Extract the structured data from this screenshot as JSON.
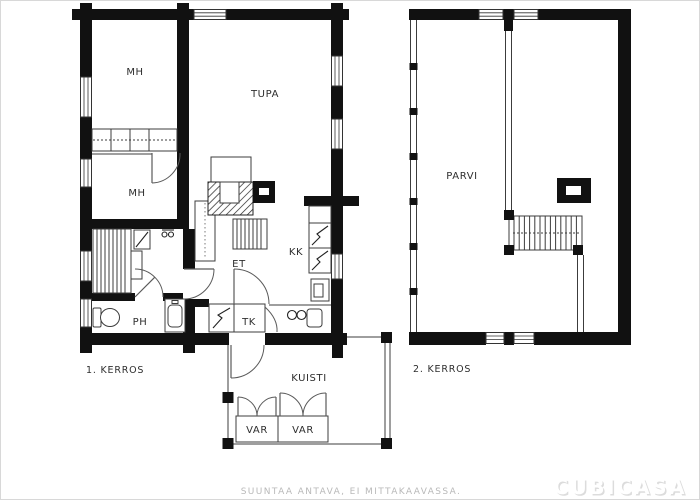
{
  "floor1": {
    "label": "1. KERROS",
    "rooms": {
      "mh1": "MH",
      "tupa": "TUPA",
      "mh2": "MH",
      "et": "ET",
      "kk": "KK",
      "ph": "PH",
      "tk": "TK"
    }
  },
  "porch": {
    "label": "KUISTI",
    "storage1": "VAR",
    "storage2": "VAR"
  },
  "floor2": {
    "label": "2. KERROS",
    "rooms": {
      "parvi": "PARVI"
    }
  },
  "footer": {
    "disclaimer": "SUUNTAA ANTAVA, EI MITTAKAAVASSA."
  },
  "watermark": {
    "brand": "CUBICASA"
  },
  "colors": {
    "wall": "#111111",
    "line": "#3c3c3c",
    "label": "#2e2e2e",
    "muted": "#b9b9b9",
    "watermark_fill": "#ffffff",
    "watermark_shadow": "#dcdcdc"
  }
}
